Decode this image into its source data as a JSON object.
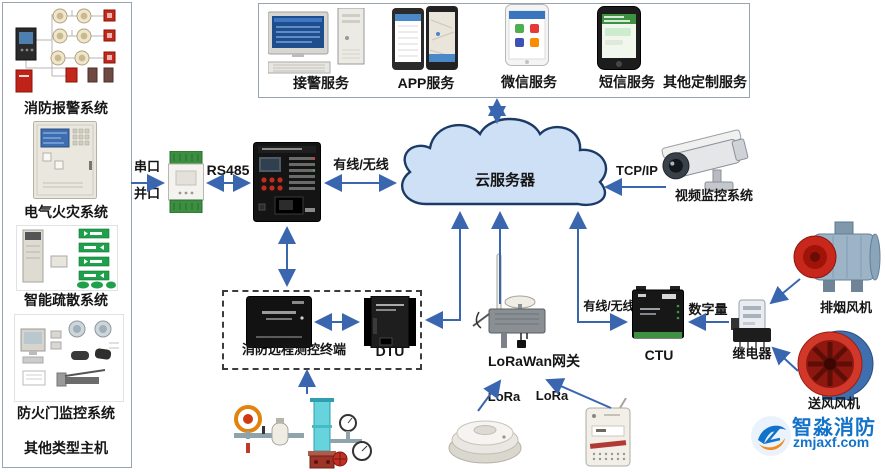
{
  "colors": {
    "arrow": "#3a66b0",
    "cloud_fill": "#cde0f5",
    "cloud_stroke": "#1c3a66",
    "exit_green": "#1fa04a",
    "alarm_red": "#c4281c",
    "watermark_blue": "#1372c9",
    "watermark_orange": "#f28a1e"
  },
  "sidebar": {
    "items": [
      {
        "label": "消防报警系统"
      },
      {
        "label": "电气火灾系统"
      },
      {
        "label": "智能疏散系统"
      },
      {
        "label": "防火门监控系统"
      },
      {
        "label": "其他类型主机"
      }
    ]
  },
  "services": {
    "items": [
      {
        "label": "接警服务"
      },
      {
        "label": "APP服务"
      },
      {
        "label": "微信服务"
      },
      {
        "label": "短信服务"
      },
      {
        "label": "其他定制服务"
      }
    ]
  },
  "cloud": {
    "label": "云服务器"
  },
  "links": {
    "serial": "串口",
    "parallel": "并口",
    "rs485": "RS485",
    "panel_cloud": "有线/无线",
    "tcpip": "TCP/IP",
    "gateway_ctu": "有线/无线",
    "digital": "数字量",
    "lora_left": "LoRa",
    "lora_right": "LoRa"
  },
  "nodes": {
    "camera": "视频监控系统",
    "remote_terminal": "消防远程测控终端",
    "dtu": "DTU",
    "gateway": "LoRaWan网关",
    "ctu": "CTU",
    "relay": "继电器",
    "smoke_fan": "排烟风机",
    "supply_fan": "送风风机"
  },
  "watermark": {
    "brand": "智淼消防",
    "site": "zmjaxf.com"
  }
}
